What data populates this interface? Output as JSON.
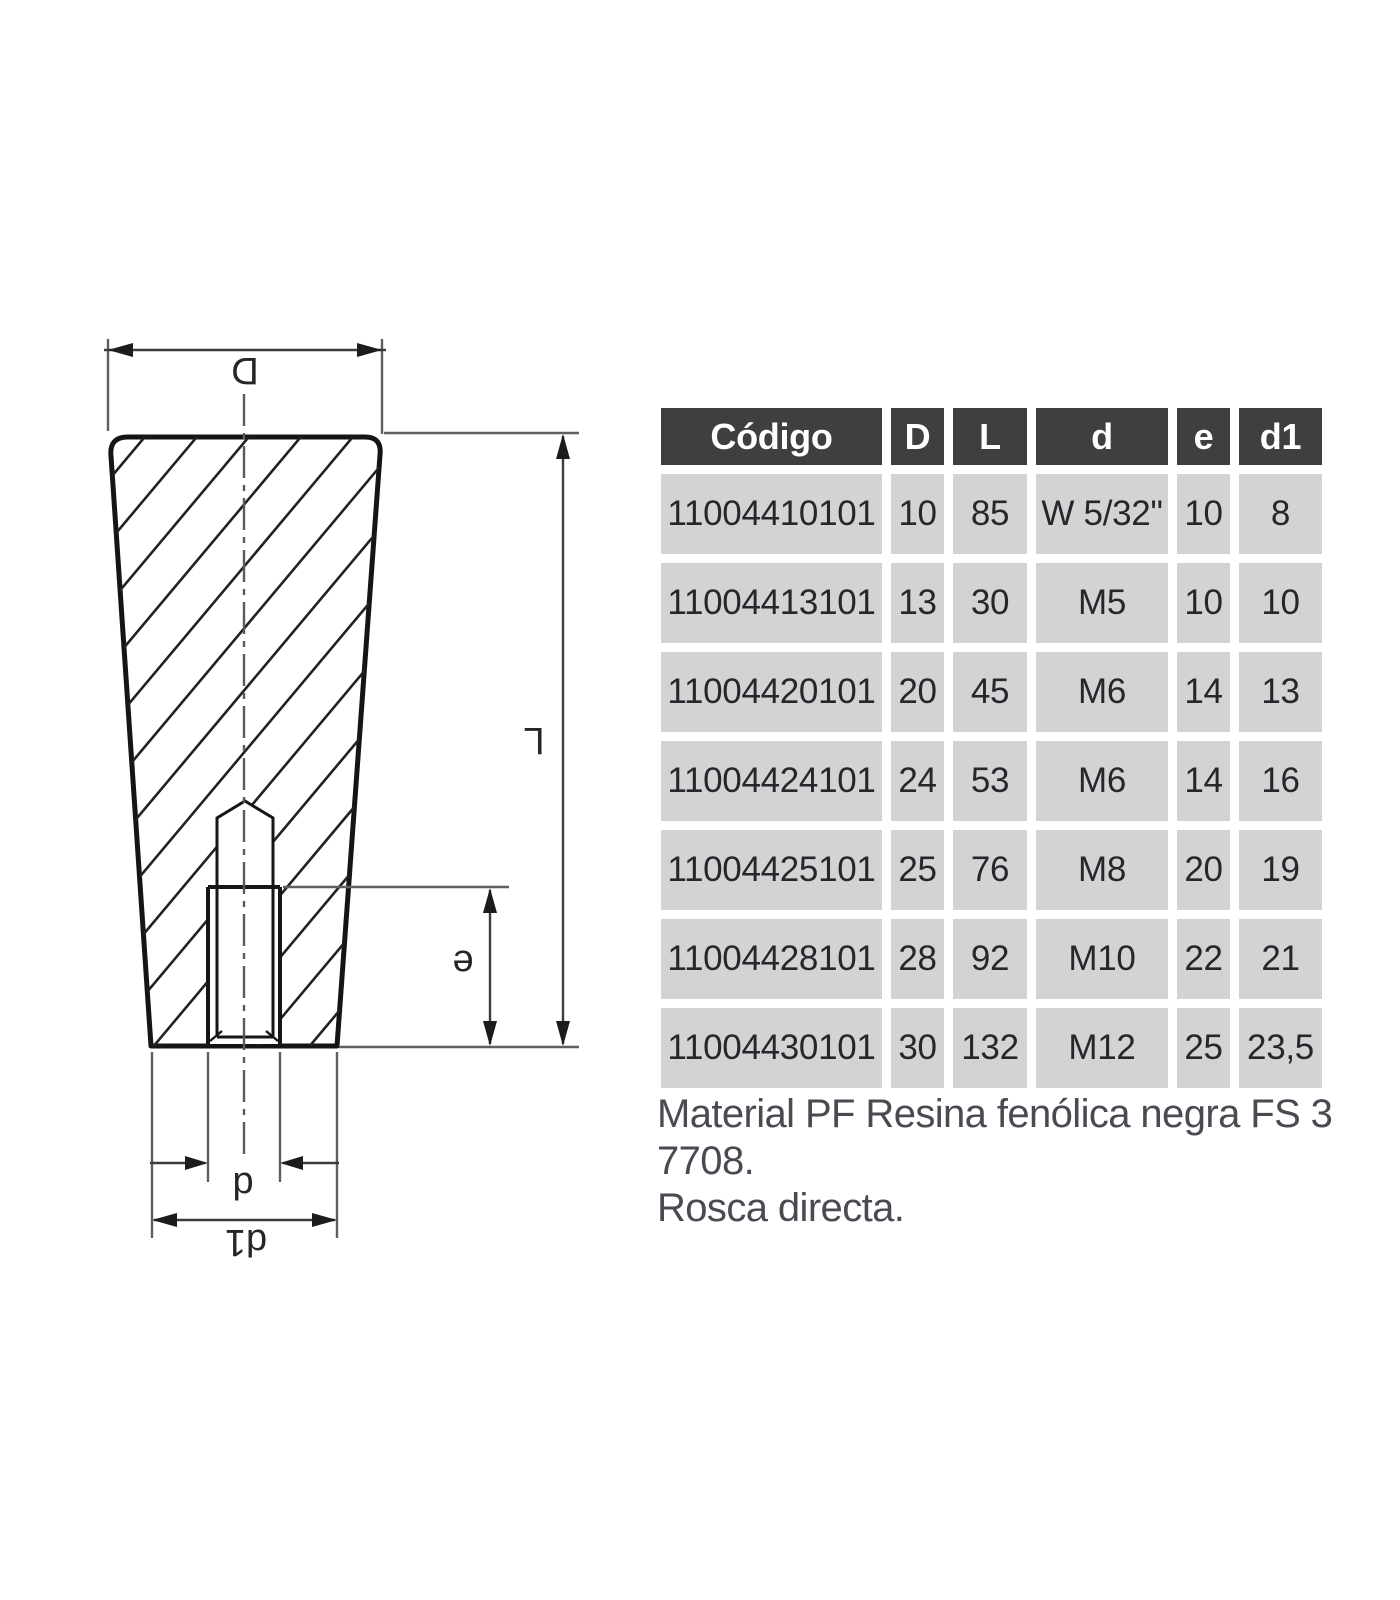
{
  "drawing": {
    "labels": {
      "D": "D",
      "L": "L",
      "e": "e",
      "d": "d",
      "d1": "d1"
    }
  },
  "table": {
    "headers": [
      "Código",
      "D",
      "L",
      "d",
      "e",
      "d1"
    ],
    "rows": [
      [
        "11004410101",
        "10",
        "85",
        "W 5/32\"",
        "10",
        "8"
      ],
      [
        "11004413101",
        "13",
        "30",
        "M5",
        "10",
        "10"
      ],
      [
        "11004420101",
        "20",
        "45",
        "M6",
        "14",
        "13"
      ],
      [
        "11004424101",
        "24",
        "53",
        "M6",
        "14",
        "16"
      ],
      [
        "11004425101",
        "25",
        "76",
        "M8",
        "20",
        "19"
      ],
      [
        "11004428101",
        "28",
        "92",
        "M10",
        "22",
        "21"
      ],
      [
        "11004430101",
        "30",
        "132",
        "M12",
        "25",
        "23,5"
      ]
    ]
  },
  "notes": {
    "lines": [
      "Material PF Resina fenólica negra FS 3",
      "7708.",
      "Rosca directa."
    ]
  },
  "colors": {
    "header_bg": "#3f3f3f",
    "header_text": "#ffffff",
    "row_bg": "#d3d3d3",
    "cell_text": "#26262c",
    "line_dark": "#1c1c1c",
    "line_gray": "#5f5f5f"
  }
}
